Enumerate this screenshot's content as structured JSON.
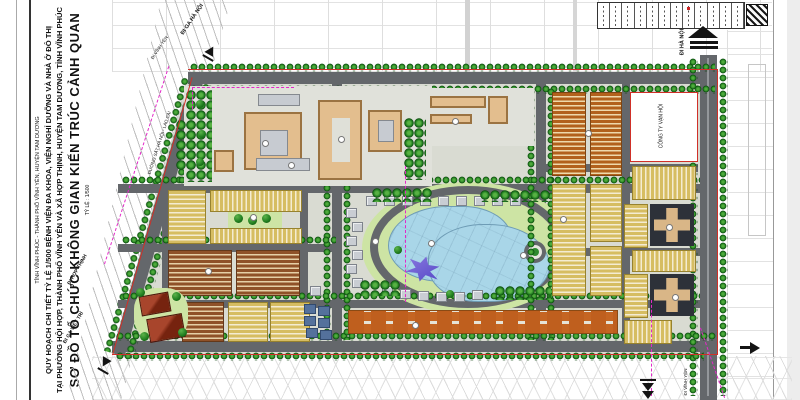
{
  "title_block": {
    "region_line": "TỈNH VĨNH PHÚC - THÀNH PHỐ VĨNH YÊN, HUYỆN TAM DƯƠNG",
    "project_line1": "QUY HOẠCH CHI TIẾT TỶ LỆ 1/500 BỆNH VIỆN ĐA KHOA, VIỆN NGHỈ DƯỠNG VÀ NHÀ Ở ĐÔ THỊ",
    "project_line2": "TẠI PHƯỜNG HỘI HỢP, THÀNH PHỐ VĨNH YÊN VÀ XÃ HỢP THỊNH, HUYỆN TAM DƯƠNG, TỈNH VĨNH PHÚC",
    "drawing_title": "SƠ ĐỒ TỔ CHỨC KHÔNG GIAN KIẾN TRÚC CẢNH QUAN",
    "scale": "TỶ LỆ : 1/500"
  },
  "map_labels": {
    "rail_to_hanoi": "ĐI GA HÀ NỘI",
    "to_vinh_yen_small": "ĐI VĨNH YÊN",
    "railway_line": "ĐƯỜNG SẮT HÀ NỘI - LÀO CAI",
    "to_hop_thinh": "ĐI HỢP THỊNH",
    "rail_to_viet_tri": "ĐI GA VIỆT TRÌ",
    "road_to_hanoi": "ĐI HÀ NỘI",
    "company_parcel": "CÔNG TY VẠN HỘI",
    "road_to_vinh_yen_city": "ĐI VĨNH YÊN"
  },
  "colors": {
    "road": "#64676b",
    "tree_green": "#1d7a1d",
    "lawn_green": "#cde4a4",
    "lake_blue": "#a9d6e8",
    "rowhouse_orange": "#b2611c",
    "rowhouse_yellow": "#d6bd62",
    "rowhouse_brown": "#8f5128",
    "roof_tan": "#e3be8e",
    "roof_red": "#a8452c",
    "tower_dark": "#2d3139",
    "boundary_red": "#d03028",
    "boundary_magenta": "#e328c8",
    "island_purple": "#6f63d4"
  }
}
